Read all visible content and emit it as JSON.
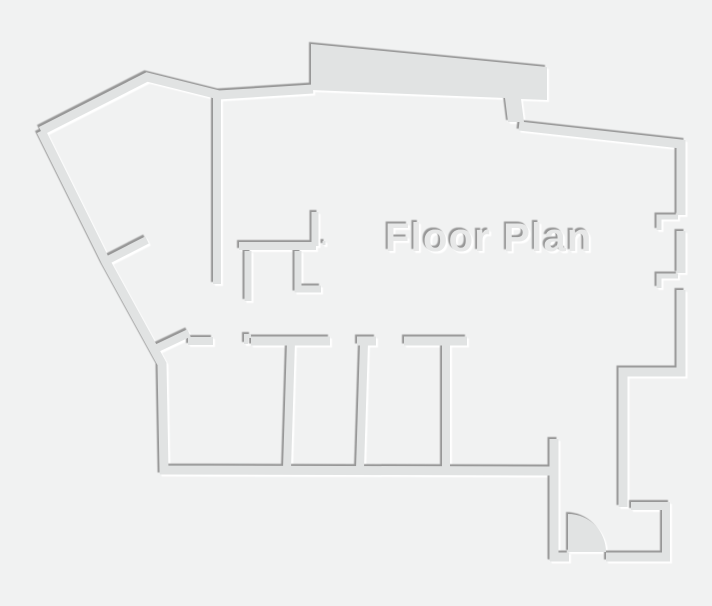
{
  "title": {
    "text": "Floor Plan"
  },
  "canvas": {
    "width": 712,
    "height": 606,
    "background_color": "#f1f2f2"
  },
  "style": {
    "wall_color": "#e1e3e3",
    "shadow_dark": "#979797",
    "shadow_light": "#ffffff",
    "title_color": "#e7e8e8",
    "title_font_size": 40,
    "title_x": 385,
    "title_y": 251
  },
  "floor_plan": {
    "polygons": [
      {
        "name": "top-bump-wall",
        "points": [
          [
            311,
            44
          ],
          [
            547,
            67
          ],
          [
            547,
            100
          ],
          [
            521,
            99
          ],
          [
            524,
            122
          ],
          [
            508,
            122
          ],
          [
            505,
            98
          ],
          [
            311,
            90
          ]
        ]
      }
    ],
    "walls": [
      {
        "name": "outer-top-left-wall",
        "width": 9,
        "points": [
          [
            41,
            131
          ],
          [
            147,
            77
          ],
          [
            219,
            95
          ],
          [
            313,
            89
          ]
        ]
      },
      {
        "name": "outer-left-and-bottom-wall",
        "width": 9,
        "points": [
          [
            41,
            131
          ],
          [
            106,
            262
          ],
          [
            162,
            364
          ],
          [
            164,
            470
          ],
          [
            551,
            471
          ]
        ]
      },
      {
        "name": "outer-top-right-wall",
        "width": 9,
        "points": [
          [
            519,
            126
          ],
          [
            681,
            144
          ],
          [
            681,
            215
          ]
        ]
      },
      {
        "name": "outer-right-mid-wall",
        "width": 9,
        "points": [
          [
            681,
            231
          ],
          [
            681,
            273
          ]
        ]
      },
      {
        "name": "outer-right-low-step-wall",
        "width": 9,
        "points": [
          [
            681,
            290
          ],
          [
            681,
            372
          ],
          [
            623,
            372
          ],
          [
            623,
            507
          ]
        ]
      },
      {
        "name": "window-jamb-upper",
        "width": 5,
        "points": [
          [
            678,
            217
          ],
          [
            659,
            217
          ],
          [
            659,
            230
          ]
        ]
      },
      {
        "name": "window-jamb-lower",
        "width": 5,
        "points": [
          [
            678,
            276
          ],
          [
            659,
            276
          ],
          [
            659,
            288
          ]
        ]
      },
      {
        "name": "entry-closet-wall",
        "width": 8,
        "points": [
          [
            631,
            506
          ],
          [
            666,
            506
          ],
          [
            666,
            555
          ]
        ]
      },
      {
        "name": "bottom-wall-left-of-door",
        "width": 9,
        "points": [
          [
            550,
            557
          ],
          [
            569,
            557
          ]
        ]
      },
      {
        "name": "bottom-wall-right-of-door",
        "width": 9,
        "points": [
          [
            606,
            557
          ],
          [
            670,
            557
          ]
        ]
      },
      {
        "name": "entry-left-wall",
        "width": 9,
        "points": [
          [
            554,
            439
          ],
          [
            554,
            561
          ]
        ]
      },
      {
        "name": "interior-vertical-wall",
        "width": 8,
        "points": [
          [
            217,
            94
          ],
          [
            217,
            284
          ]
        ]
      },
      {
        "name": "interior-diagonal-stub-upper",
        "width": 8,
        "points": [
          [
            106,
            261
          ],
          [
            147,
            240
          ]
        ]
      },
      {
        "name": "interior-diagonal-lower",
        "width": 8,
        "points": [
          [
            151,
            351
          ],
          [
            189,
            333
          ]
        ]
      },
      {
        "name": "room1-top-stub",
        "width": 8,
        "points": [
          [
            188,
            341
          ],
          [
            213,
            341
          ]
        ]
      },
      {
        "name": "room2-top-wall",
        "width": 9,
        "points": [
          [
            251,
            341
          ],
          [
            330,
            341
          ]
        ]
      },
      {
        "name": "room2-top-jog",
        "width": 4,
        "points": [
          [
            246,
            344
          ],
          [
            246,
            336
          ],
          [
            251,
            336
          ]
        ]
      },
      {
        "name": "room-divider-1",
        "width": 8,
        "points": [
          [
            291,
            341
          ],
          [
            287,
            469
          ]
        ]
      },
      {
        "name": "room3-top-cap",
        "width": 9,
        "points": [
          [
            357,
            341
          ],
          [
            376,
            341
          ]
        ]
      },
      {
        "name": "room-divider-2",
        "width": 8,
        "points": [
          [
            364,
            343
          ],
          [
            360,
            469
          ]
        ]
      },
      {
        "name": "room3-top-wall",
        "width": 9,
        "points": [
          [
            404,
            341
          ],
          [
            467,
            341
          ]
        ]
      },
      {
        "name": "room-divider-3",
        "width": 8,
        "points": [
          [
            446,
            344
          ],
          [
            446,
            469
          ]
        ]
      },
      {
        "name": "hall-wall-horizontal",
        "width": 8,
        "points": [
          [
            239,
            246
          ],
          [
            316,
            246
          ]
        ]
      },
      {
        "name": "hall-stub-up",
        "width": 7,
        "points": [
          [
            315,
            212
          ],
          [
            315,
            246
          ]
        ]
      },
      {
        "name": "hall-stub-down-left",
        "width": 7,
        "points": [
          [
            248,
            251
          ],
          [
            248,
            301
          ]
        ]
      },
      {
        "name": "hall-stub-down-right",
        "width": 7,
        "points": [
          [
            298,
            251
          ],
          [
            298,
            289
          ],
          [
            321,
            289
          ]
        ]
      },
      {
        "name": "hinge-tick",
        "width": 3,
        "points": [
          [
            324,
            241
          ],
          [
            324,
            245
          ]
        ]
      }
    ],
    "door": {
      "name": "entry-door-swing",
      "cx": 568,
      "cy": 552,
      "r": 38
    }
  }
}
